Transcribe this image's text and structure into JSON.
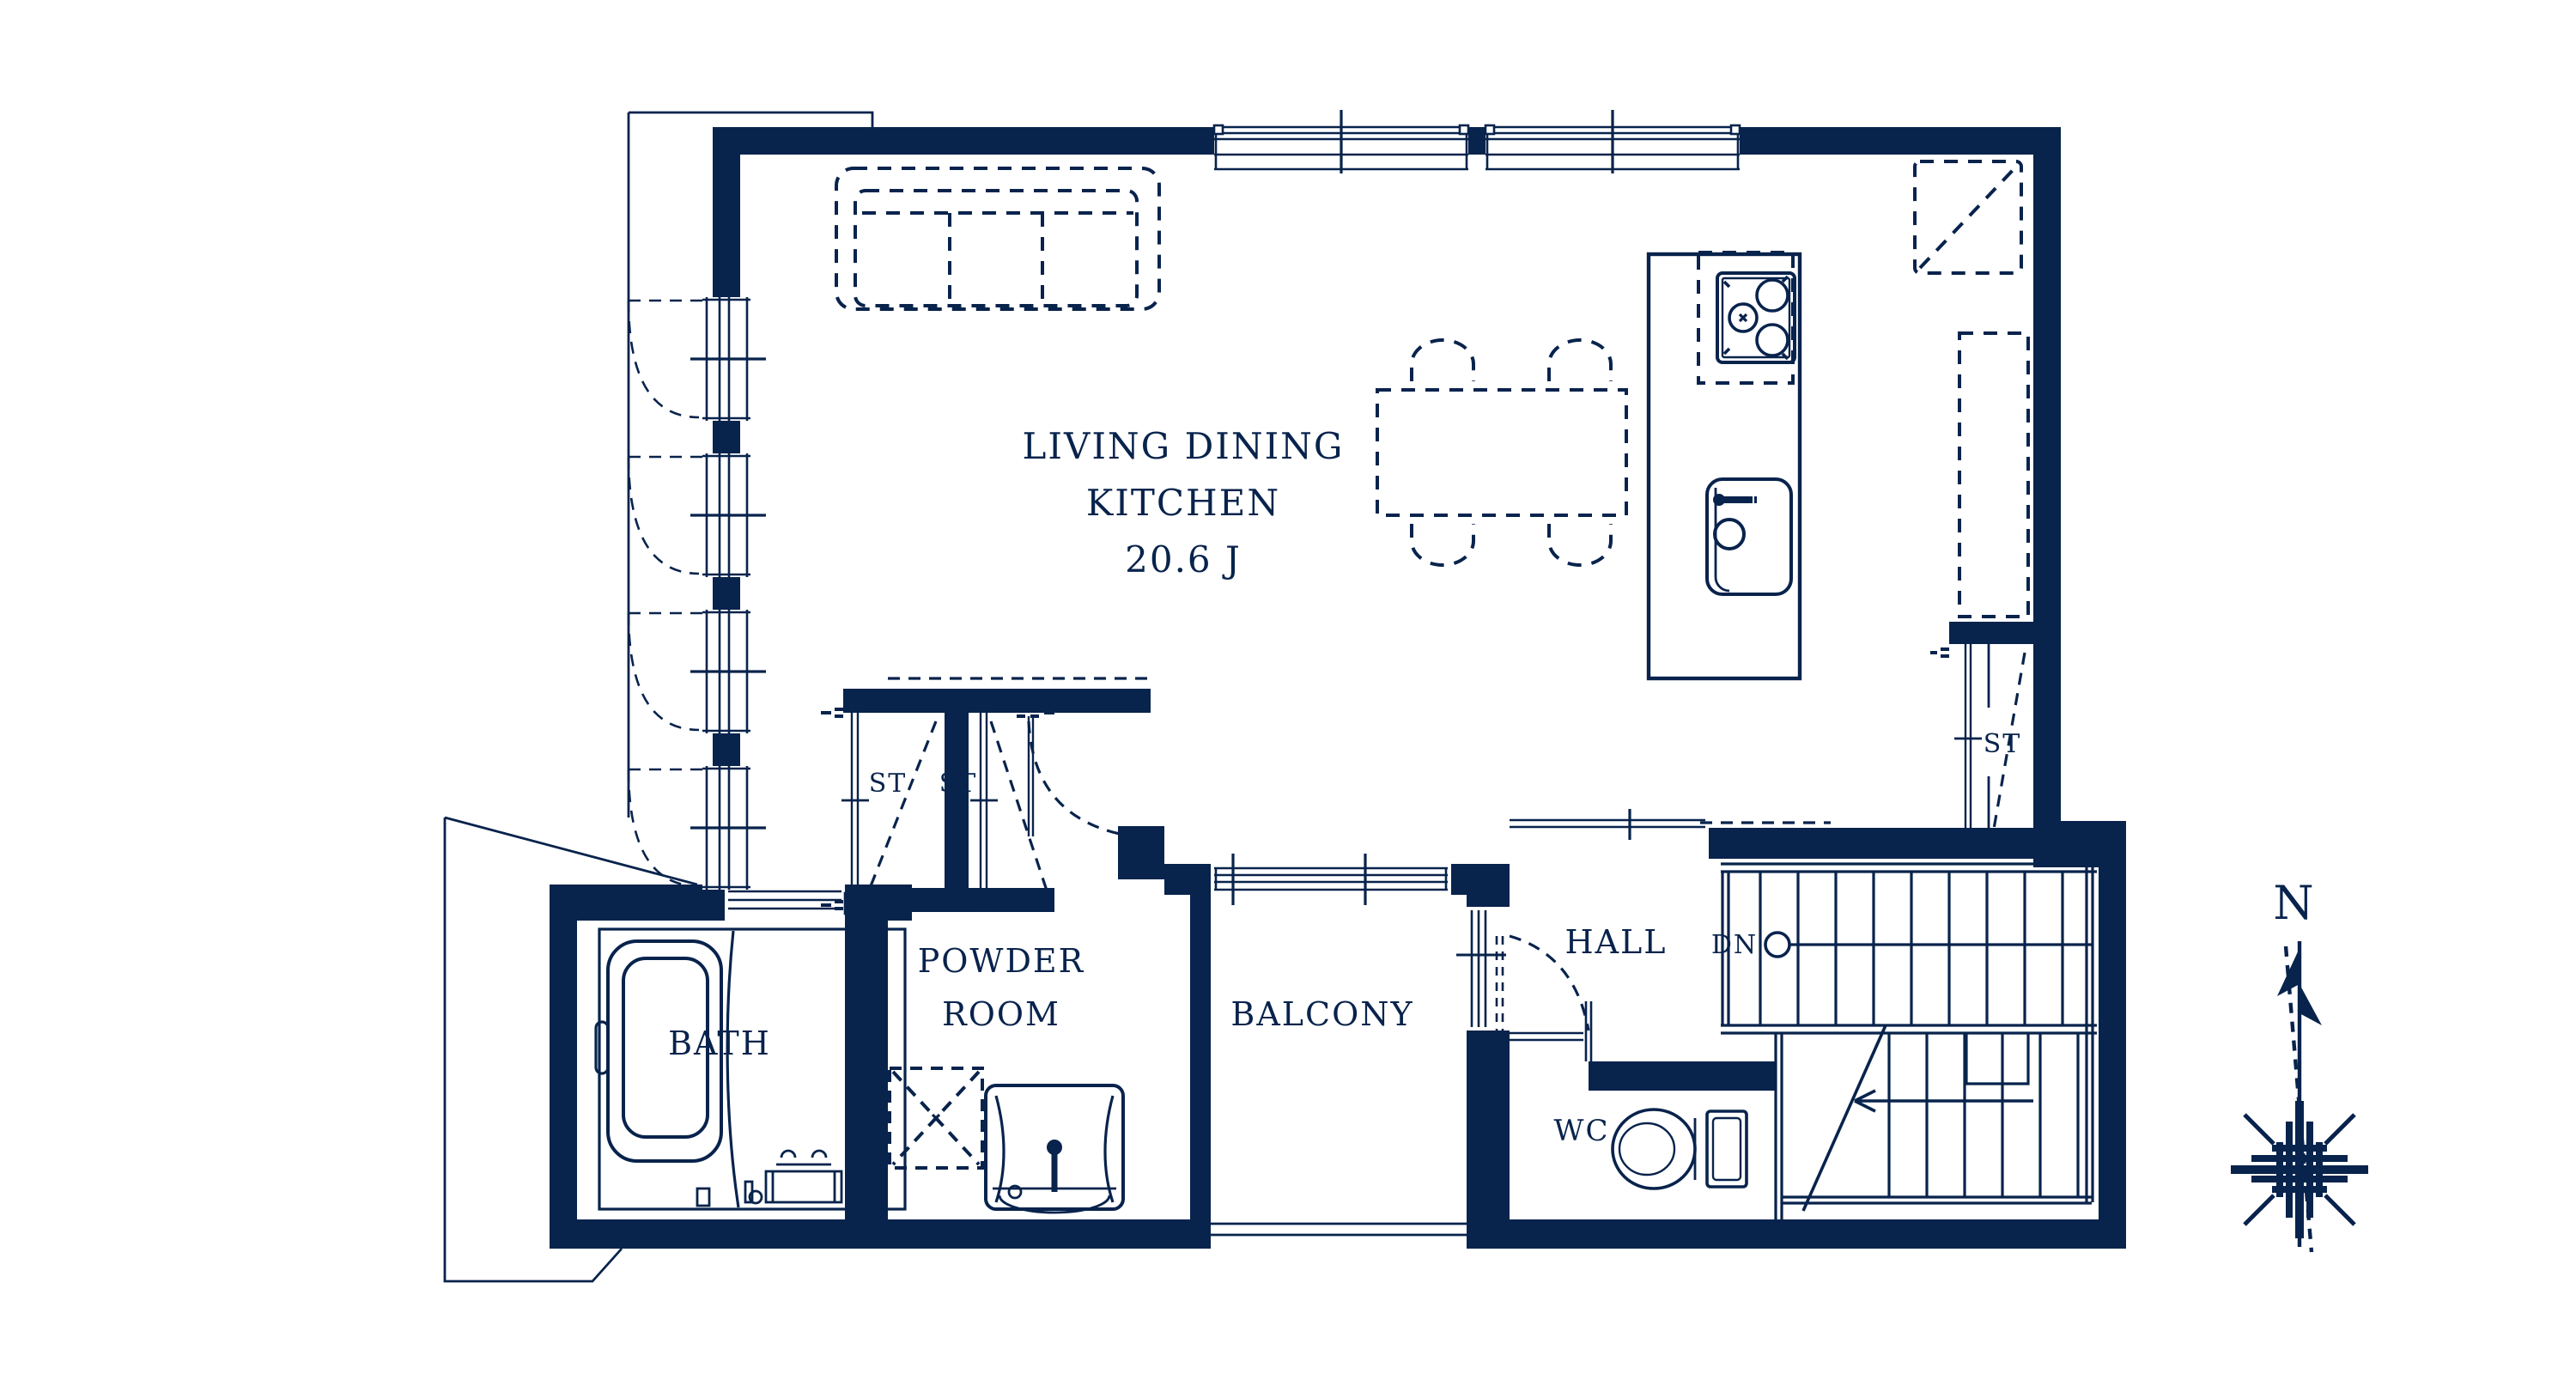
{
  "figure_type": "architectural-floor-plan",
  "rooms": {
    "ldk": {
      "line1": "LIVING DINING",
      "line2": "KITCHEN",
      "area": "20.6 J"
    },
    "powder": {
      "line1": "POWDER",
      "line2": "ROOM"
    },
    "bath": {
      "label": "BATH"
    },
    "balcony": {
      "label": "BALCONY"
    },
    "hall": {
      "label": "HALL"
    },
    "wc": {
      "label": "WC"
    }
  },
  "closets": {
    "left1": {
      "label": "ST"
    },
    "left2": {
      "label": "ST"
    },
    "right": {
      "label": "ST"
    }
  },
  "stairs": {
    "down_label": "DN"
  },
  "compass": {
    "north_label": "N"
  },
  "colors": {
    "ink": "#08234C",
    "background": "#FFFFFF"
  },
  "icons": [
    "sofa-icon",
    "dining-table-icon",
    "chair-icon",
    "kitchen-island-icon",
    "stove-icon",
    "sink-icon",
    "fridge-space-icon",
    "pantry-space-icon",
    "bathtub-icon",
    "vanity-sink-icon",
    "washer-space-icon",
    "toilet-icon",
    "stairs-icon",
    "compass-icon",
    "door-swing-icon",
    "window-icon"
  ]
}
